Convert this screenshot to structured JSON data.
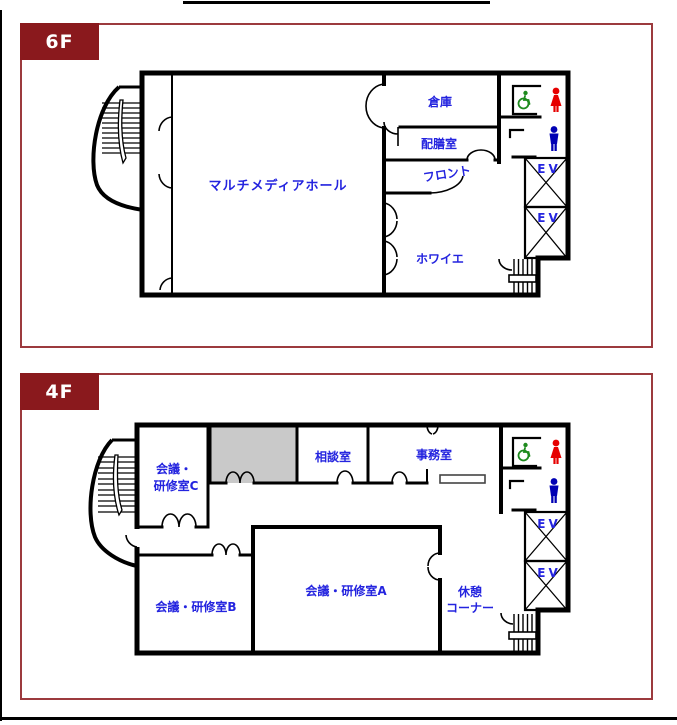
{
  "floors": [
    {
      "badge": "6F",
      "labels": {
        "hall": "マルチメディアホール",
        "storage": "倉庫",
        "pantry": "配膳室",
        "front": "フロント",
        "foyer": "ホワイエ",
        "ev_upper": "EV",
        "ev_lower": "EV"
      }
    },
    {
      "badge": "4F",
      "labels": {
        "meeting_c_line1": "会議・",
        "meeting_c_line2": "研修室C",
        "counseling": "相談室",
        "office": "事務室",
        "meeting_a": "会議・研修室A",
        "meeting_b": "会議・研修室B",
        "rest_line1": "休憩",
        "rest_line2": "コーナー",
        "ev_upper": "EV",
        "ev_lower": "EV"
      }
    }
  ],
  "icons": {
    "wheelchair": {
      "name": "wheelchair-accessible-icon",
      "color": "#1E8A1E"
    },
    "female": {
      "name": "female-restroom-icon",
      "color": "#E60000"
    },
    "male": {
      "name": "male-restroom-icon",
      "color": "#0000B4"
    },
    "elevator": {
      "name": "elevator-shaft-icon"
    },
    "stairs": {
      "name": "staircase-icon"
    }
  },
  "colors": {
    "panel_border": "#9C3A3E",
    "badge_bg": "#8A191D",
    "badge_text": "#FFFFFF",
    "room_label_blue": "#2424DF",
    "wall_black": "#000000",
    "gray_room_fill": "#C9C9C9"
  }
}
